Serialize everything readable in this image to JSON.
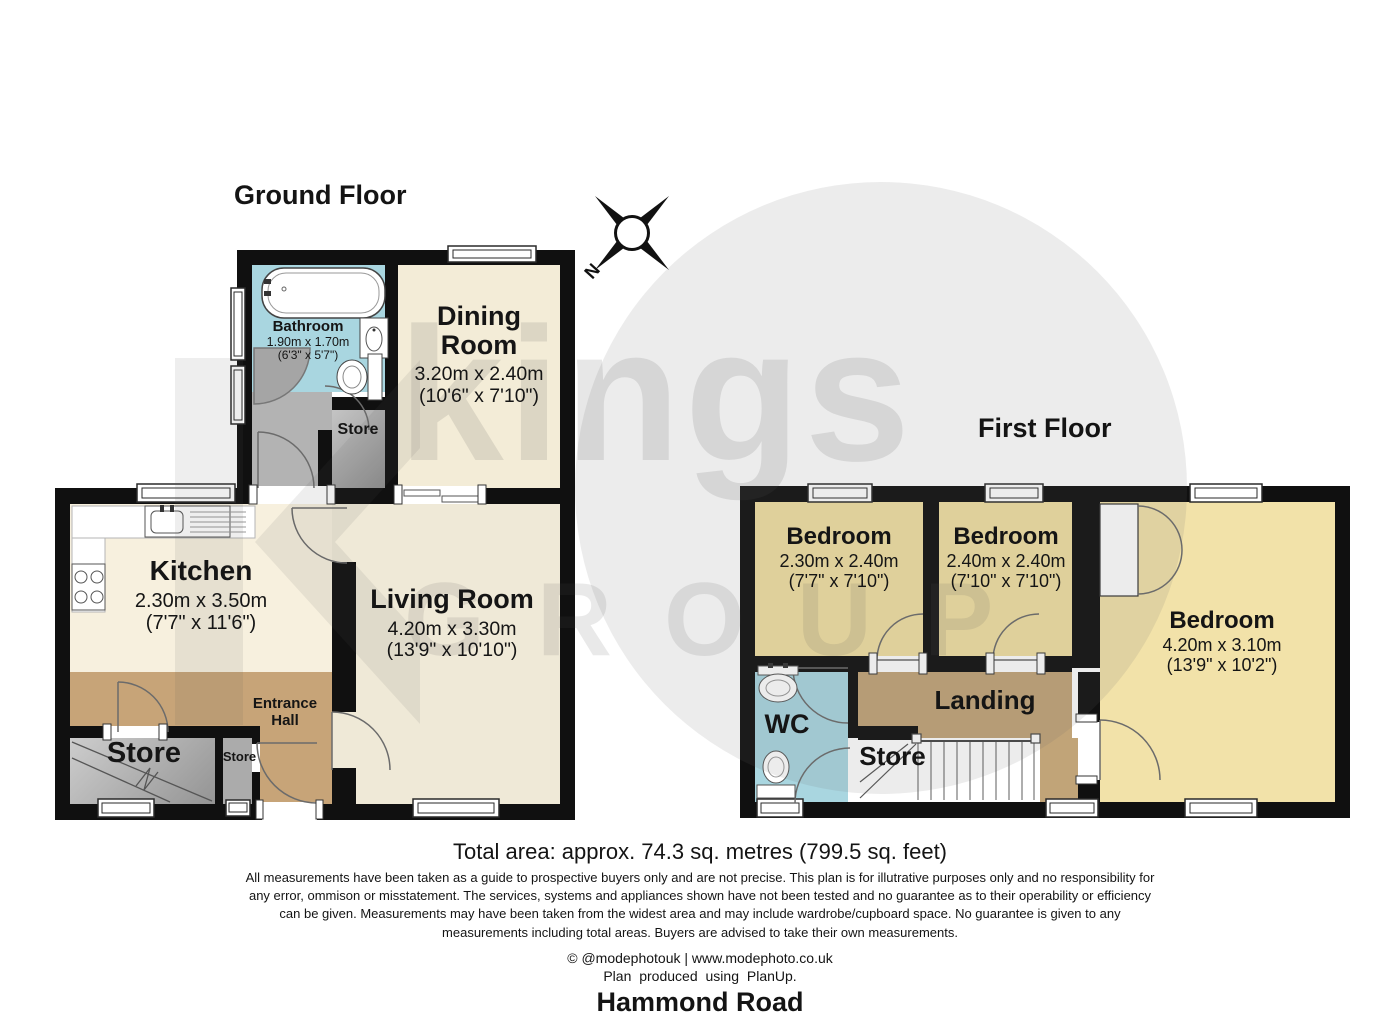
{
  "watermark": {
    "brand": "kings",
    "brand_secondary": "GROUP"
  },
  "compass": {
    "north": "N"
  },
  "ground": {
    "title": "Ground Floor",
    "rooms": {
      "bathroom": {
        "name": "Bathroom",
        "metric": "1.90m x 1.70m",
        "imperial": "(6'3\" x 5'7\")"
      },
      "dining": {
        "name": "Dining Room",
        "metric": "3.20m x 2.40m",
        "imperial": "(10'6\" x 7'10\")"
      },
      "store_upper": {
        "name": "Store"
      },
      "kitchen": {
        "name": "Kitchen",
        "metric": "2.30m x 3.50m",
        "imperial": "(7'7\" x 11'6\")"
      },
      "living": {
        "name": "Living Room",
        "metric": "4.20m x 3.30m",
        "imperial": "(13'9\" x 10'10\")"
      },
      "entrance_hall": {
        "name": "Entrance Hall"
      },
      "store": {
        "name": "Store"
      },
      "store_small": {
        "name": "Store"
      }
    }
  },
  "first": {
    "title": "First Floor",
    "rooms": {
      "bedroom_left": {
        "name": "Bedroom",
        "metric": "2.30m x 2.40m",
        "imperial": "(7'7\" x 7'10\")"
      },
      "bedroom_middle": {
        "name": "Bedroom",
        "metric": "2.40m x 2.40m",
        "imperial": "(7'10\" x 7'10\")"
      },
      "bedroom_right": {
        "name": "Bedroom",
        "metric": "4.20m x 3.10m",
        "imperial": "(13'9\" x 10'2\")"
      },
      "wc": {
        "name": "WC"
      },
      "landing": {
        "name": "Landing"
      },
      "store": {
        "name": "Store"
      }
    }
  },
  "footer": {
    "total_area": "Total area: approx. 74.3 sq. metres (799.5 sq. feet)",
    "disclaimer": "All measurements have been taken as a guide to prospective buyers only and are not precise. This plan is for illutrative purposes only and no responsibility for any error, ommison or misstatement. The services, systems and appliances shown have not been tested and no guarantee as to their operability or efficiency can be given. Measurements may have been taken from the widest area and may include wardrobe/cupboard space. No guarantee is given to any measurements including total areas. Buyers are advised to take their own measurements.",
    "credit": "© @modephotouk | www.modephoto.co.uk",
    "software_credit": "Plan produced using PlanUp.",
    "address": "Hammond Road"
  },
  "colors": {
    "wall": "#101010",
    "bathroom_blue": "#a9d6e0",
    "cream": "#f3ecd7",
    "bedroom_yellow": "#f0dfa2",
    "hall_tan": "#c7a478",
    "store_gray": "#ababab"
  }
}
